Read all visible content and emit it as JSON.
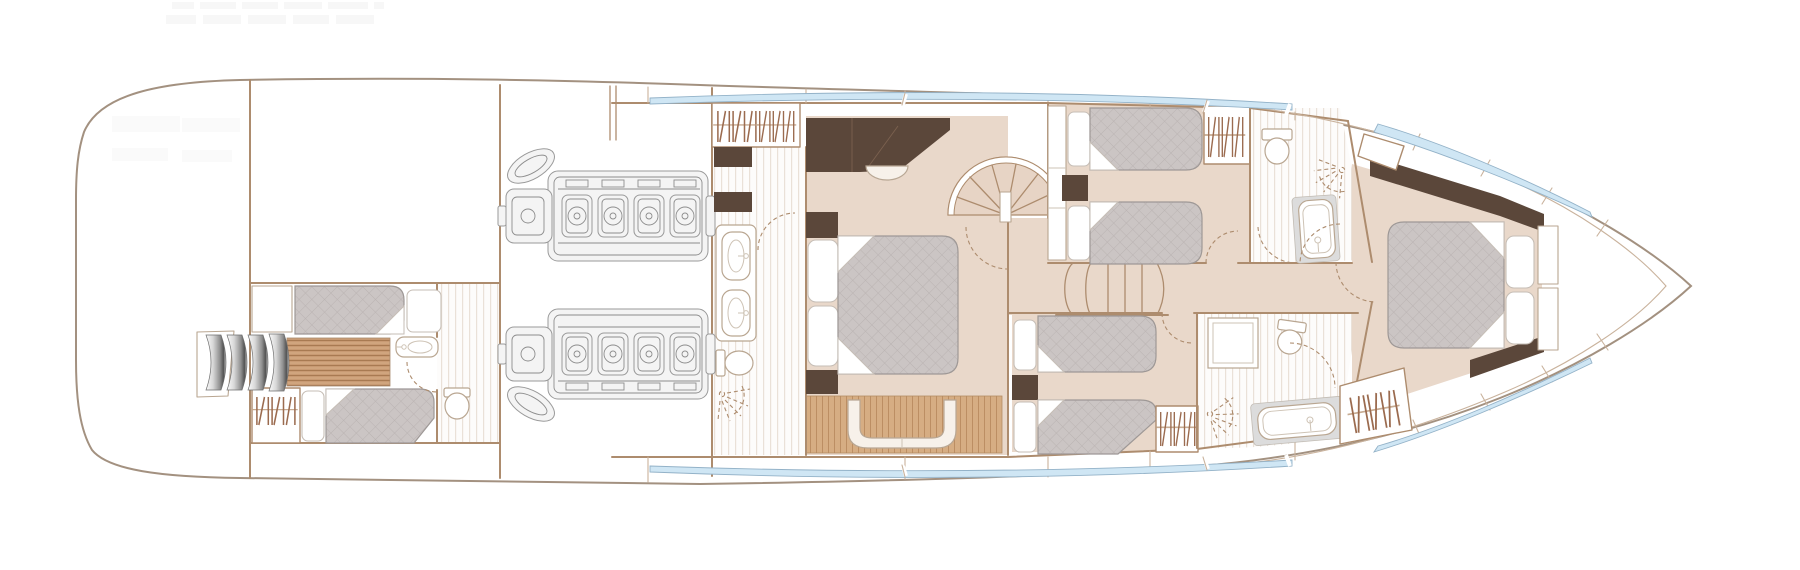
{
  "meta": {
    "title": "Motor yacht lower deck floor plan",
    "view": "top-down deck plan",
    "orientation": "bow right, stern left",
    "canvas": {
      "width": 1800,
      "height": 570
    }
  },
  "colors": {
    "hull": "#a39180",
    "wall": "#ad8c6e",
    "wall_light": "#c9b29c",
    "floor": "#e9d8ca",
    "tread": "#e7d4c5",
    "wood": "#c89a73",
    "wood_line": "#a87a52",
    "wood_hi": "#dcb68d",
    "wood_light": "#d6ad83",
    "wood_light_line": "#bc8e63",
    "mattress": "#cbc5c4",
    "mattress_line": "#bab3b2",
    "mattress_edge": "#9e9896",
    "dark_wood": "#5b473a",
    "dark_seam": "#7b614f",
    "cream": "#f7f1ea",
    "window_blue": "#cfe6f4",
    "window_edge": "#93b2c8",
    "engine": "#9a9a9a",
    "fixture_edge": "#b9a691",
    "hanger": "#9b6b4f",
    "ghost": "#f7f7f7",
    "tile_line": "#eae1d8"
  },
  "counts": {
    "engines": 2,
    "cylinder_heads_per_engine": 4,
    "cabins": 4,
    "berths": 8,
    "bathrooms": 4,
    "swim_steps": 4,
    "main_stair_treads": 6,
    "spiral_stair_treads": 6,
    "wardrobes": 5,
    "hull_window_strips": 4
  },
  "rooms": [
    {
      "id": "stern-platform",
      "name": "Stern platform and tender garage",
      "furniture": [
        "curved chrome transom steps",
        "teak companionway"
      ]
    },
    {
      "id": "crew-cabin",
      "name": "Crew cabin (aft)",
      "furniture": [
        "single berth x2",
        "wardrobe",
        "bathroom with sink and WC"
      ]
    },
    {
      "id": "engine-room",
      "name": "Engine room",
      "furniture": [
        "engine (port)",
        "engine (starboard)"
      ]
    },
    {
      "id": "master-bathroom",
      "name": "Master ensuite bathroom",
      "furniture": [
        "twin-sink vanity",
        "WC",
        "shower"
      ]
    },
    {
      "id": "master-cabin",
      "name": "Master cabin (amidships)",
      "furniture": [
        "double bed",
        "sofa dresser",
        "stool",
        "settee on wood floor",
        "wardrobe"
      ]
    },
    {
      "id": "spiral-staircase",
      "name": "Spiral staircase to main deck"
    },
    {
      "id": "main-staircase",
      "name": "Central staircase to saloon"
    },
    {
      "id": "twin-cabin-port",
      "name": "Twin guest cabin (port)",
      "furniture": [
        "single bed x2",
        "nightstand",
        "wardrobe"
      ]
    },
    {
      "id": "bathroom-port",
      "name": "Guest bathroom (port forward)",
      "furniture": [
        "WC",
        "bathtub",
        "shower"
      ]
    },
    {
      "id": "twin-cabin-starboard",
      "name": "Twin guest cabin (starboard)",
      "furniture": [
        "single bed x2",
        "nightstand",
        "wardrobe"
      ]
    },
    {
      "id": "bathroom-starboard",
      "name": "Guest bathroom (starboard forward)",
      "furniture": [
        "shower cubicle",
        "WC",
        "bathtub"
      ]
    },
    {
      "id": "vip-cabin",
      "name": "VIP cabin (bow)",
      "furniture": [
        "double bed",
        "wardrobe",
        "hull window strip x2"
      ]
    }
  ]
}
